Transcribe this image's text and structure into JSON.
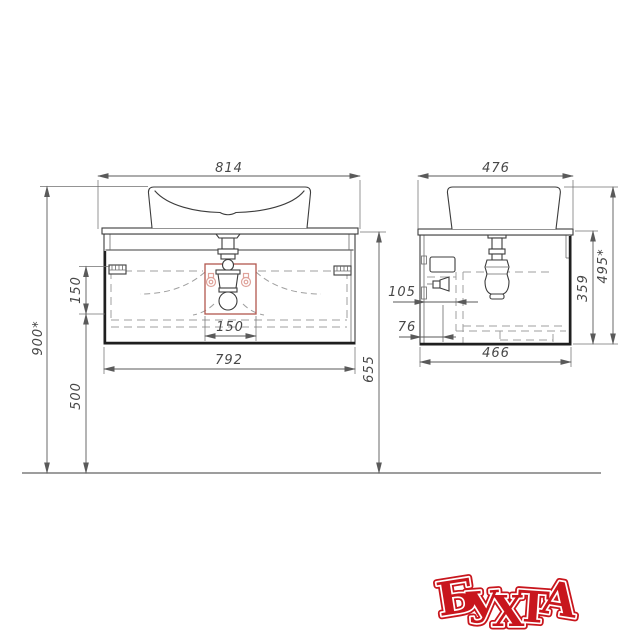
{
  "drawing": {
    "type": "bathroom vanity dimensional drawing",
    "views": [
      "front",
      "side"
    ]
  },
  "dims": {
    "w814": "814",
    "h900": "900*",
    "v150": "150",
    "c150": "150",
    "w792": "792",
    "h500": "500",
    "h655": "655",
    "w476": "476",
    "o105": "105",
    "o76": "76",
    "w466": "466",
    "h359": "359",
    "h495": "495*"
  },
  "logo": {
    "text": "БУХТА",
    "letters": [
      "Б",
      "У",
      "Х",
      "Т",
      "А"
    ],
    "color": "#c8161d"
  }
}
